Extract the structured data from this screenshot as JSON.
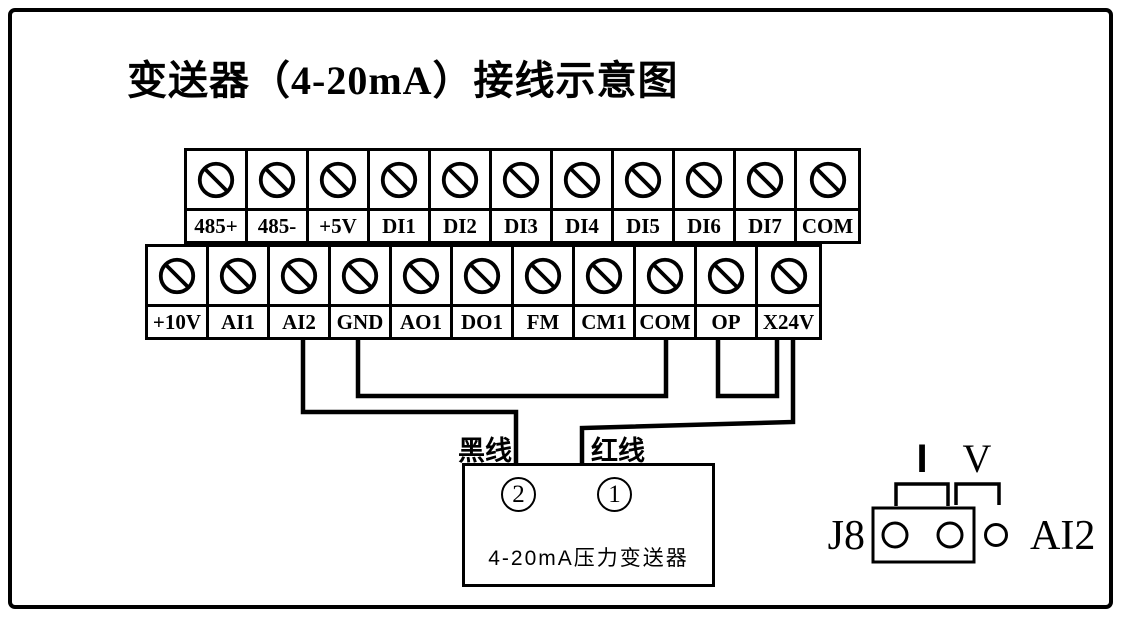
{
  "title": "变送器（4-20mA）接线示意图",
  "terminal_block": {
    "top_row": [
      "485+",
      "485-",
      "+5V",
      "DI1",
      "DI2",
      "DI3",
      "DI4",
      "DI5",
      "DI6",
      "DI7",
      "COM"
    ],
    "bottom_row": [
      "+10V",
      "AI1",
      "AI2",
      "GND",
      "AO1",
      "DO1",
      "FM",
      "CM1",
      "COM",
      "OP",
      "X24V"
    ]
  },
  "wires": {
    "black_label": "黑线",
    "red_label": "红线",
    "connections": [
      "AI2 → 黑线 → 变送器②",
      "GND → COM",
      "OP → X24V",
      "X24V → 红线 → 变送器①"
    ]
  },
  "transmitter": {
    "terminal_2": "2",
    "terminal_1": "1",
    "name": "4-20mA压力变送器"
  },
  "jumper": {
    "name": "J8",
    "mode_current": "I",
    "mode_voltage": "V",
    "channel": "AI2"
  },
  "colors": {
    "line": "#000000",
    "background": "#ffffff"
  }
}
